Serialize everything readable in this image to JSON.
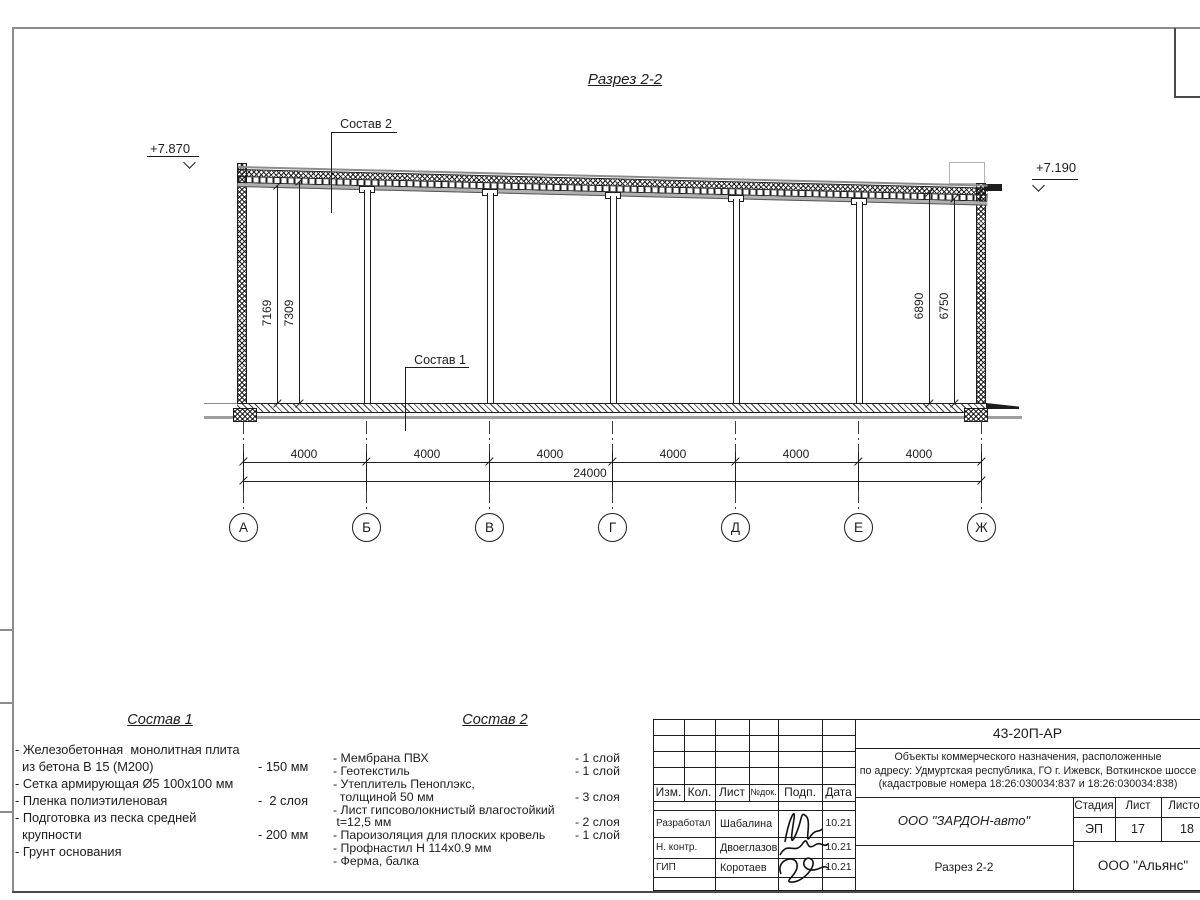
{
  "sheet": {
    "bg": "#ffffff",
    "line_color": "#1d1d1d",
    "gray_color": "#8c8c8c"
  },
  "drawing": {
    "title": "Разрез 2-2",
    "elevation_left": "+7.870",
    "elevation_right": "+7.190",
    "roof_label": "Состав 2",
    "floor_label": "Состав 1",
    "dims_vertical_left": [
      "7169",
      "7309"
    ],
    "dims_vertical_right": [
      "6890",
      "6750"
    ],
    "bay_dims": [
      "4000",
      "4000",
      "4000",
      "4000",
      "4000",
      "4000"
    ],
    "total_dim": "24000",
    "axes": [
      "А",
      "Б",
      "В",
      "Г",
      "Д",
      "Е",
      "Ж"
    ]
  },
  "sostav1": {
    "title": "Состав 1",
    "rows": [
      {
        "t": "- Железобетонная  монолитная плита",
        "v": ""
      },
      {
        "t": "  из бетона В 15 (М200)",
        "v": "- 150 мм"
      },
      {
        "t": "- Сетка армирующая Ø5 100х100 мм",
        "v": ""
      },
      {
        "t": "- Пленка полиэтиленовая",
        "v": "-  2 слоя"
      },
      {
        "t": "- Подготовка из песка средней",
        "v": ""
      },
      {
        "t": "  крупности",
        "v": "- 200 мм"
      },
      {
        "t": "- Грунт основания",
        "v": ""
      }
    ]
  },
  "sostav2": {
    "title": "Состав 2",
    "rows": [
      {
        "t": "- Мембрана ПВХ",
        "v": "- 1 слой"
      },
      {
        "t": "- Геотекстиль",
        "v": "- 1 слой"
      },
      {
        "t": "- Утеплитель Пеноплэкс,",
        "v": ""
      },
      {
        "t": "  толщиной 50 мм",
        "v": "- 3 слоя"
      },
      {
        "t": "- Лист гипсоволокнистый влагостойкий",
        "v": ""
      },
      {
        "t": " t=12,5 мм",
        "v": "- 2 слоя"
      },
      {
        "t": "- Пароизоляция для плоских кровель",
        "v": "- 1 слой"
      },
      {
        "t": "- Профнастил Н 114х0.9 мм",
        "v": ""
      },
      {
        "t": "- Ферма, балка",
        "v": ""
      }
    ]
  },
  "titleblock": {
    "doc_number": "43-20П-АР",
    "project": [
      "Объекты коммерческого назначения, расположенные",
      "по адресу: Удмуртская республика, ГО г. Ижевск, Воткинское шоссе",
      "(кадастровые номера 18:26:030034:837 и 18:26:030034:838)"
    ],
    "cols": [
      "Изм.",
      "Кол.",
      "Лист",
      "№док.",
      "Подп.",
      "Дата"
    ],
    "rows": [
      {
        "role": "Разработал",
        "name": "Шабалина",
        "date": "10.21"
      },
      {
        "role": "Н. контр.",
        "name": "Двоеглазов",
        "date": "10.21"
      },
      {
        "role": "ГИП",
        "name": "Коротаев",
        "date": "10.21"
      }
    ],
    "company": "ООО \"ЗАРДОН-авто\"",
    "sheet_name": "Разрез 2-2",
    "stage_label": "Стадия",
    "list_label": "Лист",
    "listov_label": "Листов",
    "stage": "ЭП",
    "list": "17",
    "listov": "18",
    "contractor": "ООО \"Альянс\""
  }
}
